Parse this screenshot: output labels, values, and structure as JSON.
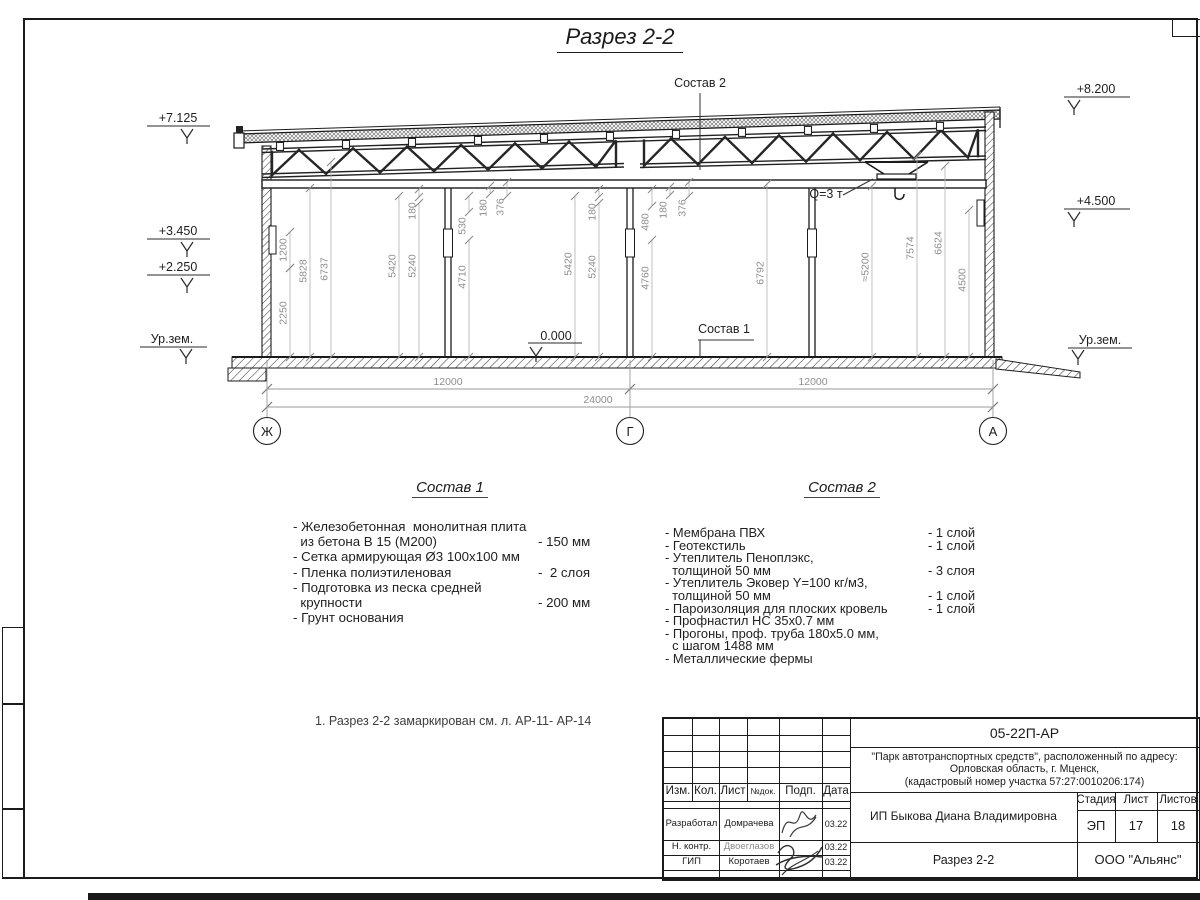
{
  "title": "Разрез 2-2",
  "drawing": {
    "callouts": [
      {
        "text": "Состав 2",
        "x": 700,
        "y": 87
      },
      {
        "text": "Состав 1",
        "x": 724,
        "y": 333
      },
      {
        "text": "Q=3 т",
        "x": 826,
        "y": 198
      }
    ],
    "elevations": [
      {
        "text": "+7.125",
        "tx": 178,
        "ty": 118,
        "shelf": [
          147,
          210,
          126
        ],
        "ax": 187,
        "ay": 138
      },
      {
        "text": "+3.450",
        "tx": 178,
        "ty": 231,
        "shelf": [
          147,
          210,
          239
        ],
        "ax": 187,
        "ay": 251
      },
      {
        "text": "+2.250",
        "tx": 178,
        "ty": 267,
        "shelf": [
          147,
          210,
          275
        ],
        "ax": 187,
        "ay": 287
      },
      {
        "text": "Ур.зем.",
        "tx": 172,
        "ty": 339,
        "shelf": [
          140,
          207,
          347
        ],
        "ax": 186,
        "ay": 358
      },
      {
        "text": "+8.200",
        "tx": 1096,
        "ty": 89,
        "shelf": [
          1064,
          1130,
          97
        ],
        "ax": 1074,
        "ay": 109
      },
      {
        "text": "+4.500",
        "tx": 1096,
        "ty": 201,
        "shelf": [
          1064,
          1130,
          209
        ],
        "ax": 1074,
        "ay": 221
      },
      {
        "text": "Ур.зем.",
        "tx": 1100,
        "ty": 340,
        "shelf": [
          1068,
          1132,
          348
        ],
        "ax": 1078,
        "ay": 359
      },
      {
        "text": "0.000",
        "tx": 556,
        "ty": 336,
        "shelf": [
          528,
          582,
          343
        ],
        "ax": 536,
        "ay": 356
      }
    ],
    "v_dims": [
      {
        "v": "1200",
        "x": 290,
        "ty": 250,
        "top": 232,
        "bot": 268
      },
      {
        "v": "2250",
        "x": 290,
        "ty": 313,
        "top": 268,
        "bot": 357
      },
      {
        "v": "5828",
        "x": 310,
        "ty": 271,
        "top": 188,
        "bot": 357
      },
      {
        "v": "6737",
        "x": 331,
        "ty": 269,
        "top": 162,
        "bot": 357
      },
      {
        "v": "5420",
        "x": 399,
        "ty": 266,
        "top": 196,
        "bot": 357
      },
      {
        "v": "5240",
        "x": 419,
        "ty": 266,
        "top": 203,
        "bot": 357
      },
      {
        "v": "180",
        "x": 419,
        "ty": 211,
        "top": 189,
        "bot": 197
      },
      {
        "v": "530",
        "x": 469,
        "ty": 226,
        "top": 196,
        "bot": 212
      },
      {
        "v": "180",
        "x": 490,
        "ty": 208,
        "top": 186,
        "bot": 194
      },
      {
        "v": "376",
        "x": 507,
        "ty": 207,
        "top": 182,
        "bot": 196
      },
      {
        "v": "4710",
        "x": 469,
        "ty": 277,
        "top": 240,
        "bot": 357
      },
      {
        "v": "5420",
        "x": 575,
        "ty": 264,
        "top": 196,
        "bot": 357
      },
      {
        "v": "5240",
        "x": 599,
        "ty": 267,
        "top": 203,
        "bot": 357
      },
      {
        "v": "180",
        "x": 599,
        "ty": 212,
        "top": 189,
        "bot": 197
      },
      {
        "v": "480",
        "x": 652,
        "ty": 222,
        "top": 189,
        "bot": 206
      },
      {
        "v": "4760",
        "x": 652,
        "ty": 278,
        "top": 240,
        "bot": 357
      },
      {
        "v": "180",
        "x": 670,
        "ty": 210,
        "top": 187,
        "bot": 195
      },
      {
        "v": "376",
        "x": 689,
        "ty": 208,
        "top": 182,
        "bot": 196
      },
      {
        "v": "6792",
        "x": 767,
        "ty": 273,
        "top": 184,
        "bot": 357
      },
      {
        "v": "≈5200",
        "x": 872,
        "ty": 267,
        "top": 186,
        "bot": 357
      },
      {
        "v": "7574",
        "x": 917,
        "ty": 248,
        "top": 156,
        "bot": 357
      },
      {
        "v": "6624",
        "x": 945,
        "ty": 243,
        "top": 166,
        "bot": 357
      },
      {
        "v": "4500",
        "x": 969,
        "ty": 280,
        "top": 210,
        "bot": 357
      }
    ],
    "h_dims": [
      {
        "v": "12000",
        "x": 448,
        "y": 385
      },
      {
        "v": "12000",
        "x": 813,
        "y": 385
      },
      {
        "v": "24000",
        "x": 598,
        "y": 403
      }
    ],
    "axes": [
      {
        "label": "Ж",
        "x": 267
      },
      {
        "label": "Г",
        "x": 630
      },
      {
        "label": "А",
        "x": 993
      }
    ]
  },
  "sostav1": {
    "title": "Состав 1",
    "rows": [
      {
        "t": "- Железобетонная  монолитная плита"
      },
      {
        "t": "  из бетона В 15 (М200)",
        "q": "- 150 мм"
      },
      {
        "t": "- Сетка армирующая Ø3 100х100 мм"
      },
      {
        "t": "- Пленка полиэтиленовая",
        "q": "-  2 слоя"
      },
      {
        "t": "- Подготовка из песка средней"
      },
      {
        "t": "  крупности",
        "q": "- 200 мм"
      },
      {
        "t": "- Грунт основания"
      }
    ]
  },
  "sostav2": {
    "title": "Состав 2",
    "rows": [
      {
        "t": "- Мембрана ПВХ",
        "q": "- 1 слой"
      },
      {
        "t": "- Геотекстиль",
        "q": "- 1 слой"
      },
      {
        "t": "- Утеплитель Пеноплэкс,"
      },
      {
        "t": "  толщиной 50 мм",
        "q": "- 3 слоя"
      },
      {
        "t": "- Утеплитель Эковер Y=100 кг/м3,"
      },
      {
        "t": "  толщиной 50 мм",
        "q": "- 1 слой"
      },
      {
        "t": "- Пароизоляция для плоских кровель",
        "q": "- 1 слой"
      },
      {
        "t": "- Профнастил НС 35х0.7 мм"
      },
      {
        "t": "- Прогоны, проф. труба 180х5.0 мм,"
      },
      {
        "t": "  с шагом 1488 мм"
      },
      {
        "t": "- Металлические фермы"
      }
    ]
  },
  "note": "1. Разрез 2-2 замаркирован см. л. АР-11- АР-14",
  "stamp": {
    "doc_number": "05-22П-АР",
    "project_line1": "\"Парк автотранспортных средств\",  расположенный по адресу:",
    "project_line2": "Орловская область, г. Мценск,",
    "project_line3": "(кадастровый номер участка 57:27:0010206:174)",
    "client": "ИП Быкова Диана Владимировна",
    "sheet_title": "Разрез 2-2",
    "company": "ООО \"Альянс\"",
    "headers": {
      "izm": "Изм.",
      "kol": "Кол.",
      "list": "Лист",
      "ndoc": "№док.",
      "podp": "Подп.",
      "data": "Дата",
      "stage": "Стадия",
      "sheet": "Лист",
      "sheets": "Листов"
    },
    "stage_value": "ЭП",
    "sheet_value": "17",
    "sheets_value": "18",
    "rows": [
      {
        "role": "Разработал",
        "name": "Домрачева",
        "date": "03.22"
      },
      {
        "role": "Н. контр.",
        "name": "Двоеглазов",
        "date": "03.22"
      },
      {
        "role": "ГИП",
        "name": "Коротаев",
        "date": "03.22"
      }
    ]
  }
}
